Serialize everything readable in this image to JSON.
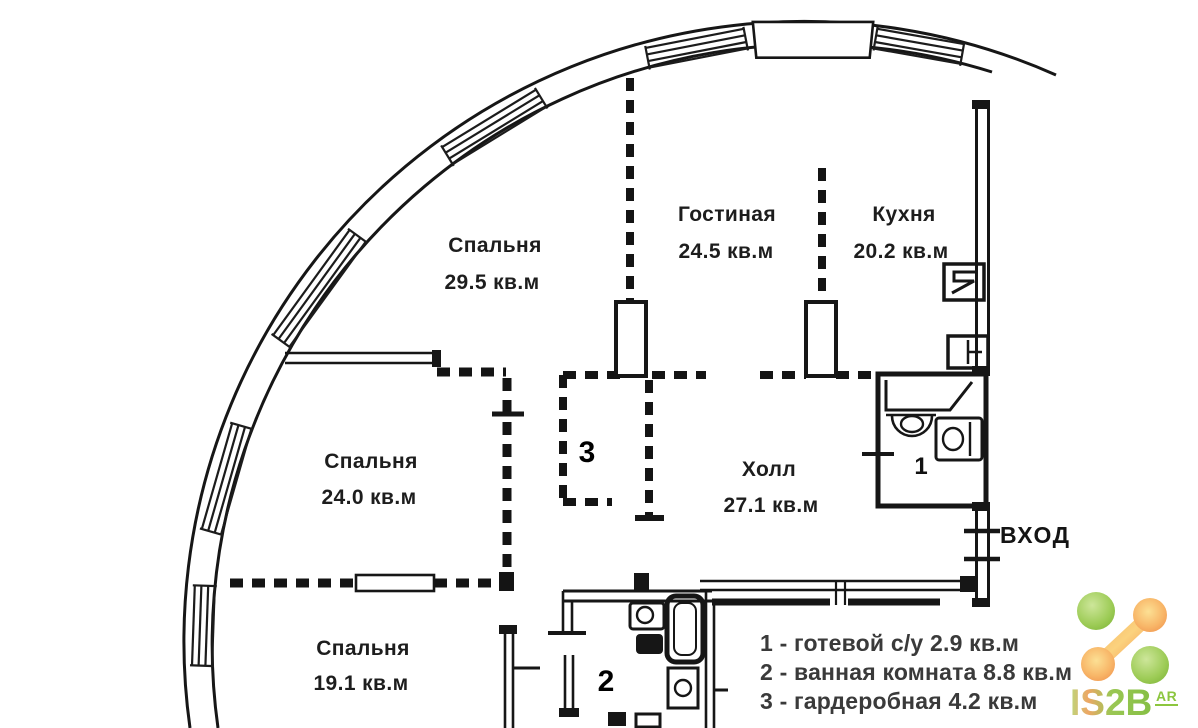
{
  "plan": {
    "rooms": {
      "bedroom_top": {
        "name": "Спальня",
        "area": "29.5 кв.м"
      },
      "living_room": {
        "name": "Гостиная",
        "area": "24.5 кв.м"
      },
      "kitchen": {
        "name": "Кухня",
        "area": "20.2 кв.м"
      },
      "bedroom_middle": {
        "name": "Спальня",
        "area": "24.0 кв.м"
      },
      "hall": {
        "name": "Холл",
        "area": "27.1 кв.м"
      },
      "bedroom_bottom": {
        "name": "Спальня",
        "area": "19.1 кв.м"
      }
    },
    "markers": {
      "guest_wc": "1",
      "bathroom": "2",
      "wardrobe": "3"
    },
    "entrance_label": "ВХОД",
    "legend": [
      "1 - готевой с/у 2.9 кв.м",
      "2 - ванная комната 8.8 кв.м",
      "3 - гардеробная 4.2 кв.м"
    ]
  },
  "watermark": {
    "brand": "IS2B",
    "suffix": "AR"
  },
  "colors": {
    "wall": "#161616",
    "logo_green": "#8cc63f",
    "logo_orange": "#f59a50"
  }
}
